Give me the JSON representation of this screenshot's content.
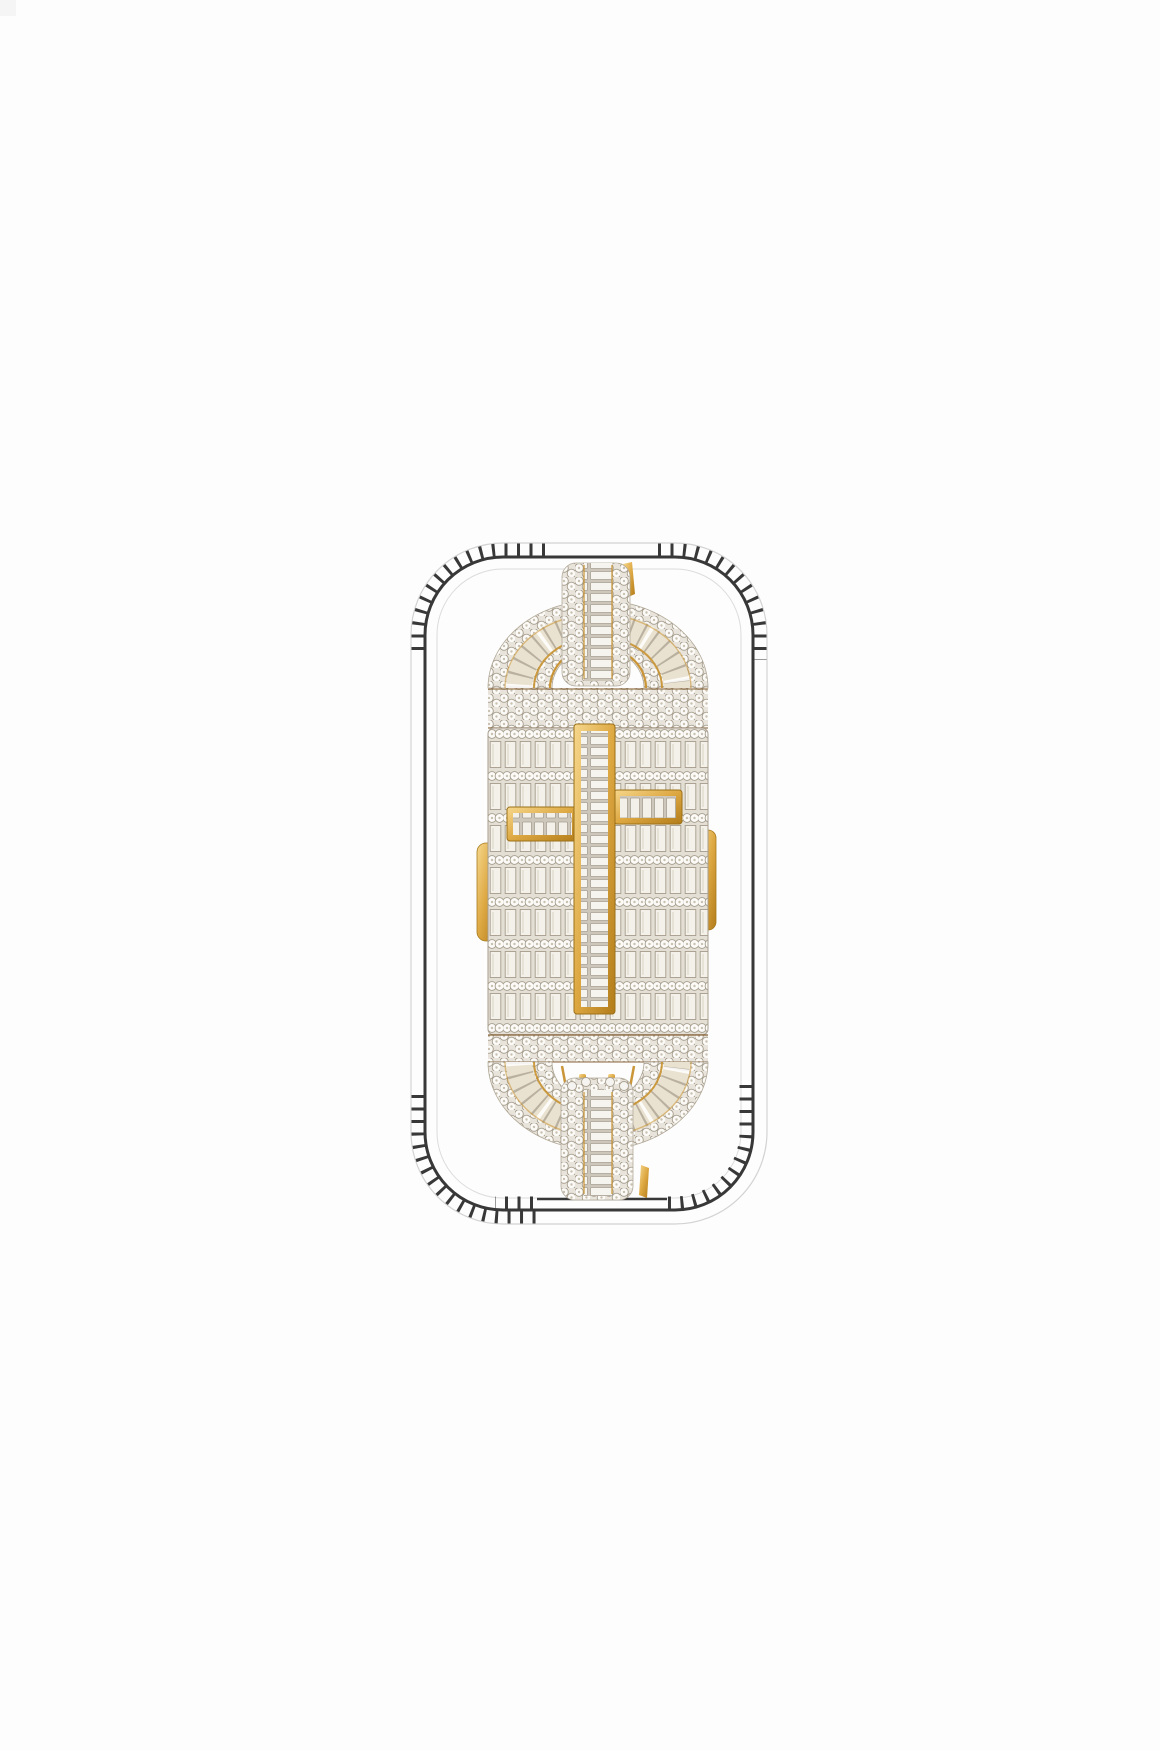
{
  "page": {
    "background_color": "#fdfdfd"
  },
  "photo": {
    "alt": "Iced-out diamond pave chain-link clasp pendant with a yellow gold baguette cross, shown centered inside a hand-drawn ticked rounded-rectangle outline on a white background",
    "outline_color": "#383838",
    "gold_color": "#c8912f",
    "diamond_color": "#f2efe8",
    "background_color": "#ffffff"
  }
}
